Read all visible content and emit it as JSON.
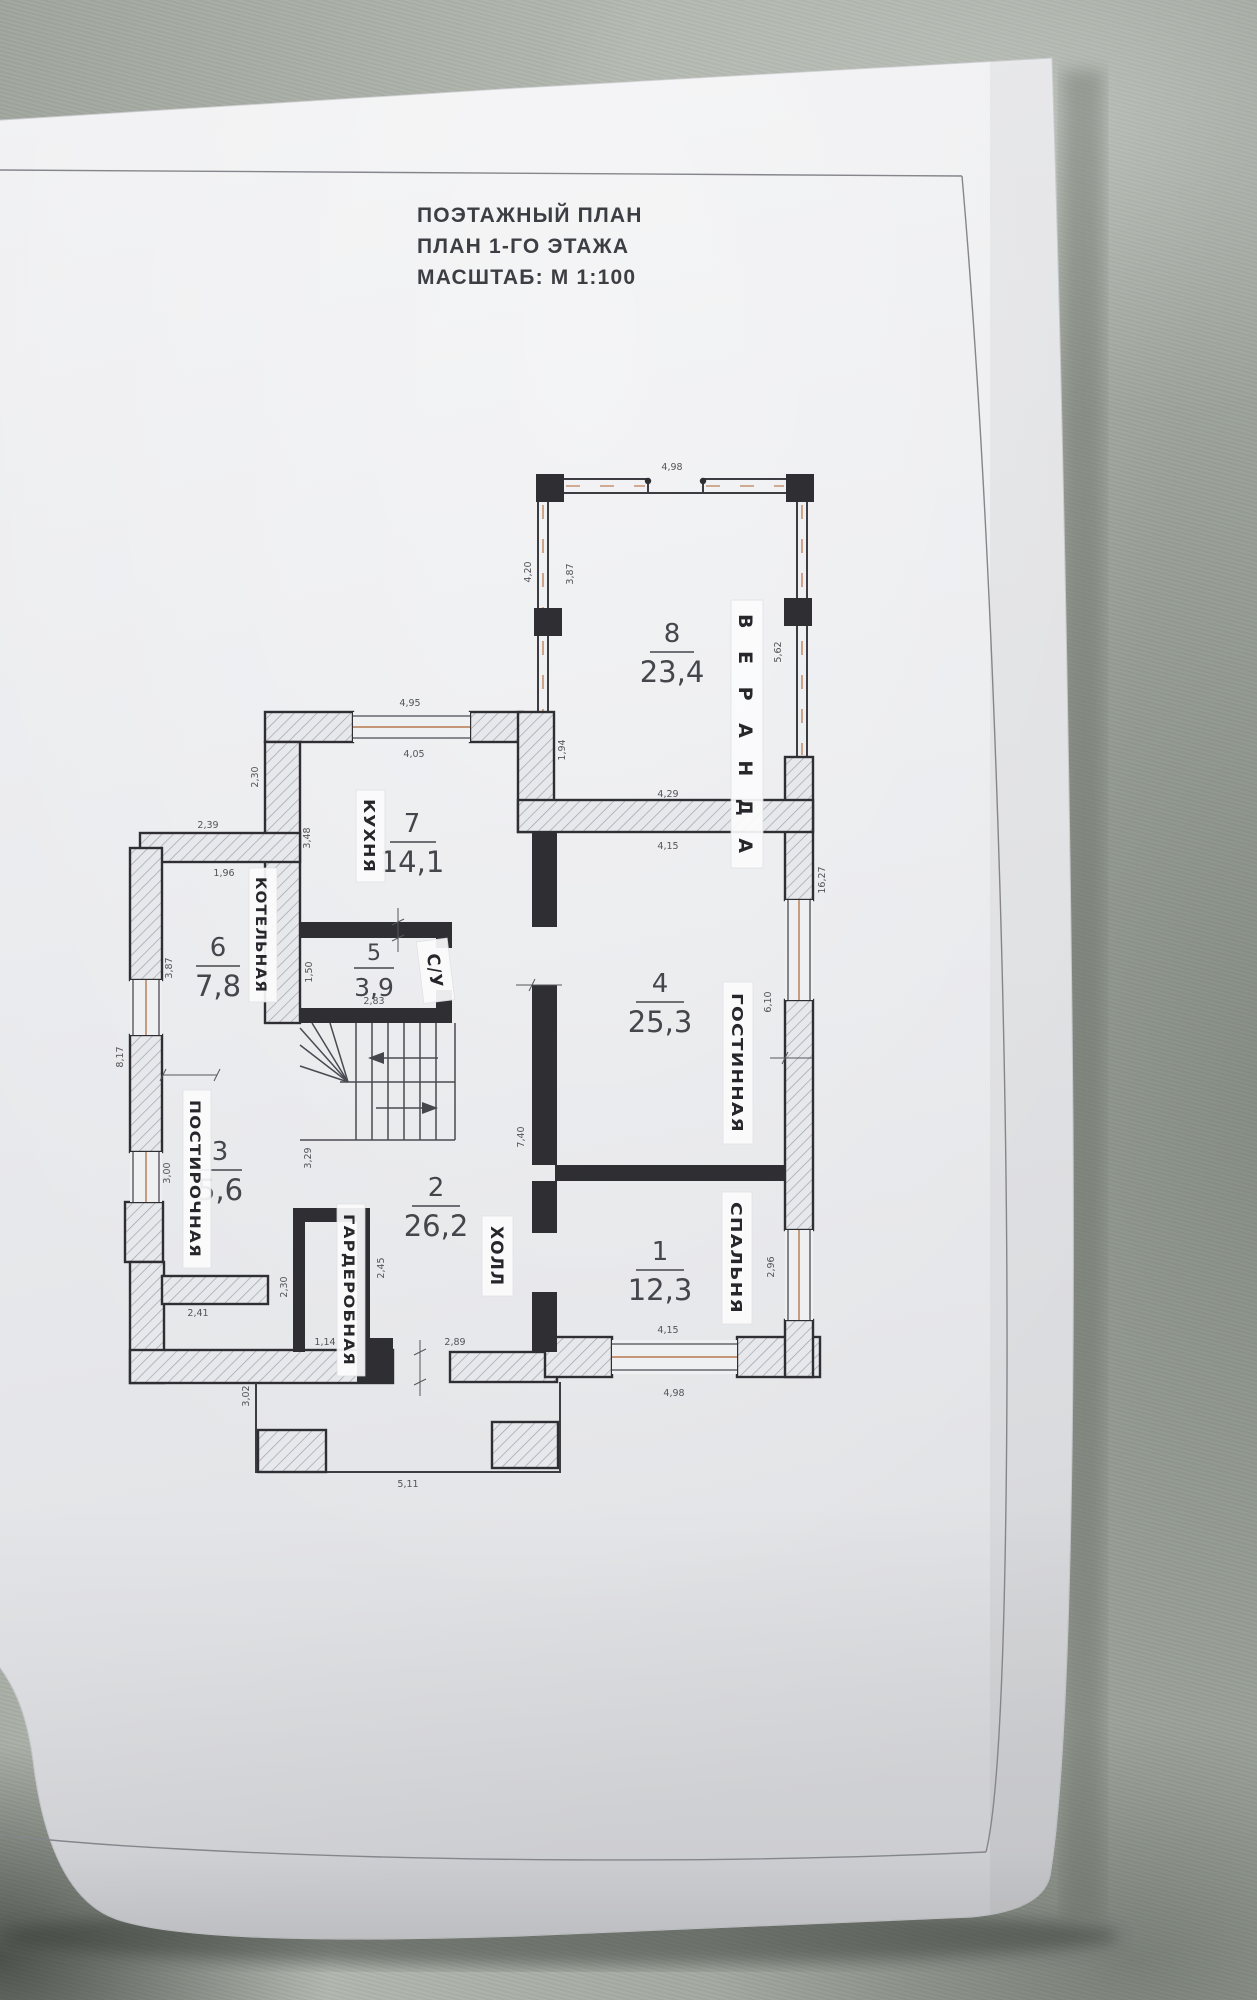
{
  "title": {
    "lines": [
      "ПОЭТАЖНЫЙ ПЛАН",
      "ПЛАН 1-ГО ЭТАЖА",
      "МАСШТАБ: М 1:100"
    ]
  },
  "rooms": [
    {
      "number": "1",
      "area": "12,3",
      "label": "СПАЛЬНЯ"
    },
    {
      "number": "2",
      "area": "26,2",
      "label": "ХОЛЛ"
    },
    {
      "number": "3",
      "area": "5,6",
      "label": "ПОСТИРОЧНАЯ"
    },
    {
      "number": "4",
      "area": "25,3",
      "label": "ГОСТИННАЯ"
    },
    {
      "number": "5",
      "area": "3,9",
      "label": "С/У"
    },
    {
      "number": "6",
      "area": "7,8",
      "label": "КОТЕЛЬНАЯ"
    },
    {
      "number": "7",
      "area": "14,1",
      "label": "КУХНЯ"
    },
    {
      "number": "8",
      "area": "23,4",
      "label": "ВЕРАНДА"
    }
  ],
  "dims": {
    "veranda_top": "4,98",
    "veranda_left_outer": "4,20",
    "veranda_left_inner": "3,87",
    "veranda_right": "5,62",
    "kitchen_top_outer": "4,95",
    "kitchen_top_inner": "4,05",
    "kitchen_left": "2,30",
    "kitchen_left_lower": "3,48",
    "kitchen_veranda": "1,94",
    "boiler_top_outer": "2,39",
    "boiler_top_inner": "1,96",
    "boiler_left": "3,87",
    "left_outer": "8,17",
    "laundry_left": "3,00",
    "wc_left": "1,50",
    "wc_bottom": "2,83",
    "living_top_outer": "4,29",
    "living_top_inner": "4,15",
    "living_right": "6,10",
    "right_outer": "16,27",
    "bedroom_right": "2,96",
    "bedroom_bottom_inner": "4,15",
    "bedroom_bottom_outer": "4,98",
    "hall_right": "7,40",
    "stairs_left": "3,29",
    "wardrobe_left": "2,30",
    "hall_left": "2,45",
    "wardrobe_bottom": "1,14",
    "entry": "2,89",
    "bottom_left": "2,41",
    "porch_left": "3,02",
    "porch_bottom": "5,11"
  },
  "colors": {
    "paper": "#ededf0",
    "fabric": "#aeb4ac",
    "wall": "#2e2e33",
    "window_accent": "#b5774e"
  }
}
